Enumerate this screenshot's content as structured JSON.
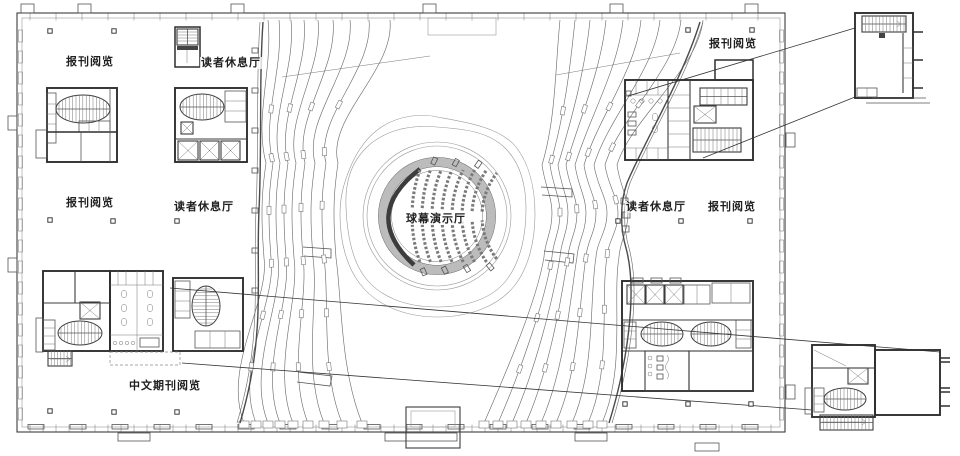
{
  "drawing": {
    "type": "architectural-floor-plan",
    "labels": {
      "top_left_reading": "报刊阅览",
      "top_left_lounge": "读者休息厅",
      "mid_left_reading": "报刊阅览",
      "mid_left_lounge": "读者休息厅",
      "dome_hall": "球幕演示厅",
      "top_right_reading": "报刊阅览",
      "mid_right_lounge": "读者休息厅",
      "mid_right_reading": "报刊阅览",
      "bottom_chinese_periodicals": "中文期刊阅览"
    }
  },
  "colors": {
    "background": "#ffffff",
    "linework": "#6f6f6f",
    "walls": "#2f2f2f",
    "ring_fill": "#bcbcbc",
    "label_text": "#1f1f1f"
  }
}
